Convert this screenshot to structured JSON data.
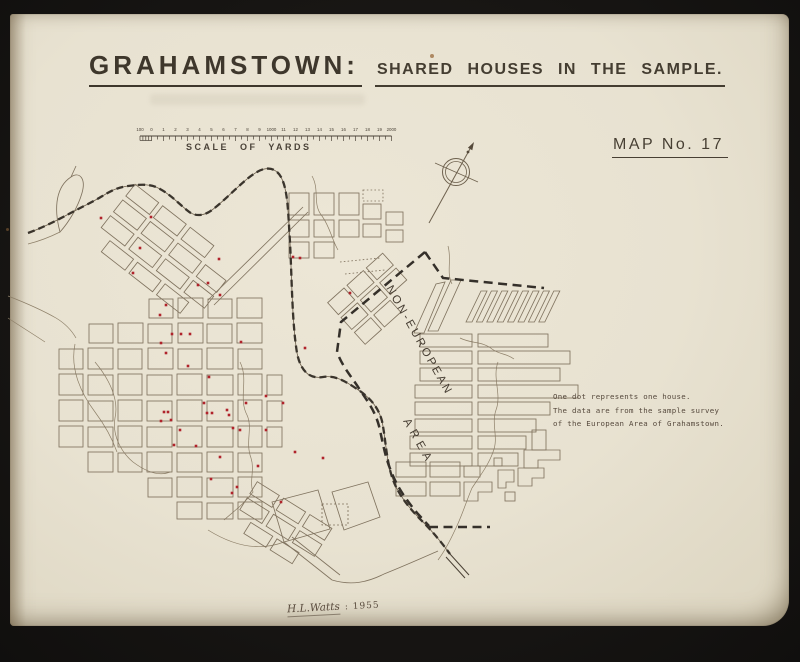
{
  "header": {
    "title": "GRAHAMSTOWN:",
    "subtitle": "SHARED HOUSES IN THE SAMPLE.",
    "map_no": "MAP No. 17"
  },
  "scale": {
    "label": "SCALE OF YARDS",
    "tick_labels": [
      "100",
      "0",
      "1",
      "2",
      "3",
      "4",
      "5",
      "6",
      "7",
      "8",
      "9",
      "1000",
      "11",
      "12",
      "13",
      "14",
      "15",
      "16",
      "17",
      "18",
      "19",
      "2000"
    ]
  },
  "map": {
    "area_label": {
      "line1": "NON-EUROPEAN",
      "line2": "AREA"
    },
    "dot_color": "#b0232b",
    "dots": [
      [
        101,
        218
      ],
      [
        151,
        217
      ],
      [
        140,
        248
      ],
      [
        133,
        273
      ],
      [
        219,
        259
      ],
      [
        198,
        285
      ],
      [
        208,
        283
      ],
      [
        220,
        295
      ],
      [
        166,
        305
      ],
      [
        160,
        315
      ],
      [
        172,
        334
      ],
      [
        181,
        334
      ],
      [
        190,
        334
      ],
      [
        161,
        343
      ],
      [
        166,
        353
      ],
      [
        241,
        342
      ],
      [
        293,
        257
      ],
      [
        300,
        258
      ],
      [
        350,
        293
      ],
      [
        305,
        348
      ],
      [
        188,
        366
      ],
      [
        209,
        377
      ],
      [
        266,
        396
      ],
      [
        246,
        403
      ],
      [
        204,
        403
      ],
      [
        207,
        413
      ],
      [
        212,
        413
      ],
      [
        229,
        415
      ],
      [
        164,
        412
      ],
      [
        168,
        412
      ],
      [
        161,
        421
      ],
      [
        171,
        420
      ],
      [
        227,
        410
      ],
      [
        233,
        428
      ],
      [
        240,
        430
      ],
      [
        211,
        479
      ],
      [
        220,
        457
      ],
      [
        232,
        493
      ],
      [
        237,
        487
      ],
      [
        281,
        502
      ],
      [
        283,
        403
      ],
      [
        295,
        452
      ],
      [
        323,
        458
      ],
      [
        266,
        430
      ],
      [
        180,
        430
      ],
      [
        174,
        445
      ],
      [
        196,
        446
      ],
      [
        258,
        466
      ]
    ]
  },
  "note": {
    "lines": [
      "One dot represents one house.",
      "The data are from the sample survey",
      "of the European Area of Grahamstown."
    ]
  },
  "signature": {
    "name": "H.L.Watts",
    "year": ": 1955"
  },
  "colors": {
    "paper": "#e8e2d1",
    "frame": "#191715",
    "ink": "#3e372c",
    "street": "#80735f",
    "railway": "#3a342c",
    "boundary": "#35302a",
    "dot": "#b0232b"
  }
}
